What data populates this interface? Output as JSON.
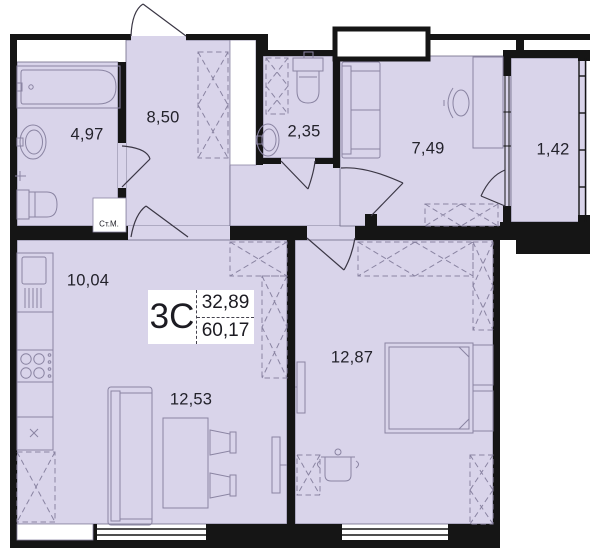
{
  "plan": {
    "title_block": {
      "type_label": "3С",
      "upper_area": "32,89",
      "total_area": "60,17"
    },
    "rooms": {
      "bathroom": {
        "area": "4,97"
      },
      "hallway": {
        "area": "8,50"
      },
      "wc": {
        "area": "2,35"
      },
      "room_small": {
        "area": "7,49"
      },
      "balcony": {
        "area": "1,42"
      },
      "kitchen": {
        "area": "10,04"
      },
      "living": {
        "area": "12,53"
      },
      "bedroom": {
        "area": "12,87"
      }
    },
    "annotations": {
      "washing_machine": "Ст.М."
    },
    "colors": {
      "room_fill": "#d9d4ea",
      "wall": "#151515",
      "furniture_stroke": "#8a84a2",
      "room_outline": "#6f6987",
      "door_stroke": "#3a3644"
    }
  }
}
